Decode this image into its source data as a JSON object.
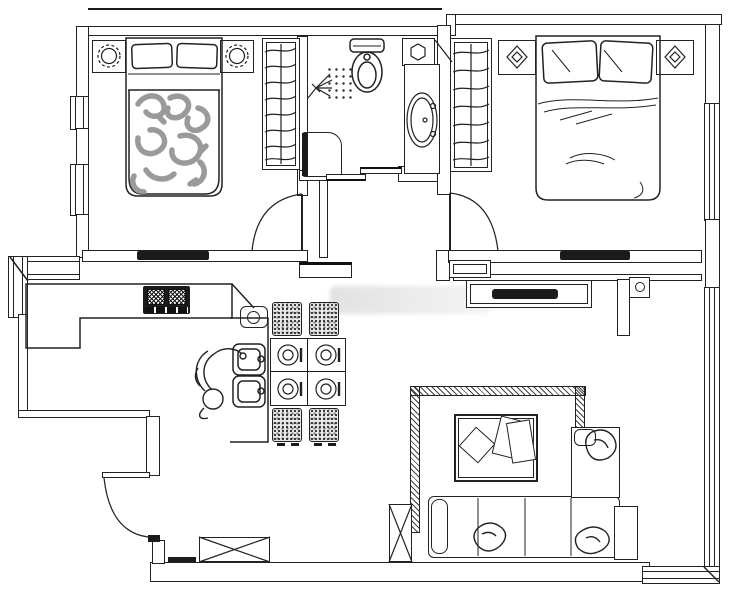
{
  "figure": {
    "kind": "apartment floor plan",
    "drawing_style": "black-line CAD top view",
    "background": "#ffffff",
    "line_color": "#222222",
    "duvet_pattern_color": "#9a9a9a",
    "solid_fill": "#1b1b1b"
  },
  "rooms": {
    "bedroom_left": {
      "label": "Bedroom (top-left)",
      "items": [
        "nightstand-with-round-lamp",
        "double-bed-with-patterned-duvet",
        "nightstand-with-round-lamp",
        "wardrobe-with-hangers",
        "wall-tv"
      ]
    },
    "bathroom": {
      "label": "Bathroom",
      "items": [
        "toilet",
        "shower-head-spray",
        "washing-machine",
        "vanity-cabinet",
        "vanity-basin",
        "sliding-door"
      ]
    },
    "bedroom_right": {
      "label": "Bedroom (top-right)",
      "items": [
        "wardrobe-with-hangers",
        "nightstand-with-diamond-lamp",
        "double-bed",
        "nightstand-with-diamond-lamp",
        "wall-tv"
      ]
    },
    "hallway": {
      "label": "Hallway",
      "items": [
        "bedroom-left-door",
        "bedroom-right-door",
        "threshold-sill-left",
        "threshold-sill-right"
      ]
    },
    "kitchen": {
      "label": "Kitchen",
      "items": [
        "l-shaped-counter",
        "two-burner-gas-stove",
        "corner-unit-with-bowl",
        "double-sink",
        "person-figure"
      ]
    },
    "dining": {
      "label": "Dining area",
      "items": [
        "table-with-four-place-settings",
        "chair",
        "chair",
        "chair",
        "chair"
      ]
    },
    "entry": {
      "label": "Entry",
      "items": [
        "outward-swinging-entry-door",
        "door-mat",
        "shoe-cabinet-x"
      ]
    },
    "living_room": {
      "label": "Living room",
      "items": [
        "sideboard-with-tv",
        "partition-stub-with-downlight",
        "hatched-rug-border",
        "coffee-table-with-trays",
        "l-shaped-sofa",
        "x-side-table",
        "end-table",
        "throw-pillows"
      ]
    }
  },
  "openings": {
    "windows": [
      "left-wall-window-upper",
      "left-wall-window-lower",
      "kitchen-corner-window",
      "right-wall-window-upper",
      "right-wall-window-lower",
      "bottom-right-corner-window"
    ],
    "doors": [
      "bedroom-left-door",
      "bedroom-right-door",
      "bathroom-sliding-door",
      "entry-door"
    ]
  },
  "watermark": {
    "legible": false
  }
}
